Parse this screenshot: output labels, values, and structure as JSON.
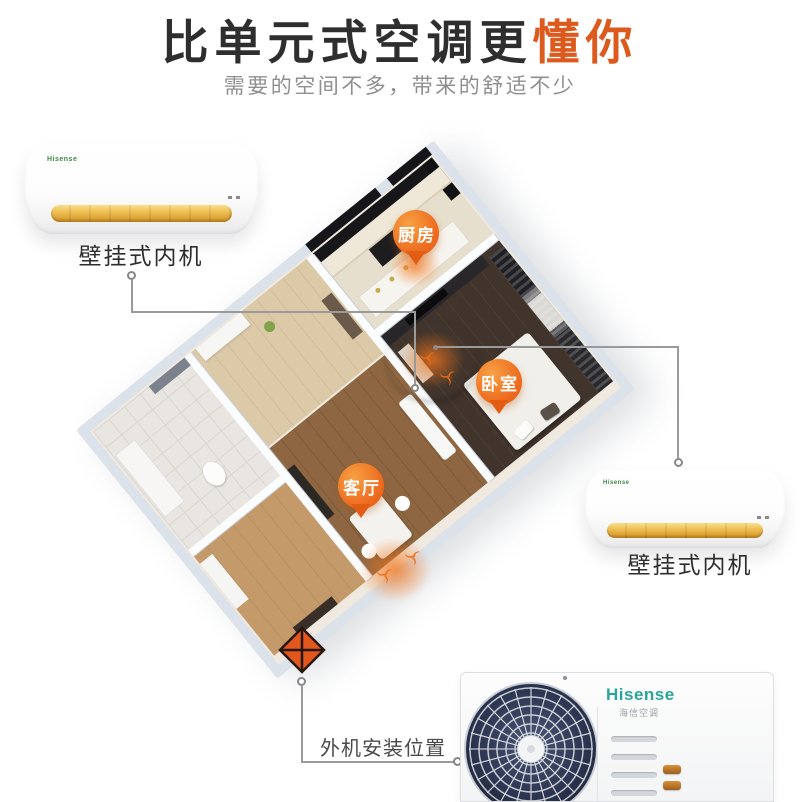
{
  "header": {
    "title_main": "比单元式空调更",
    "title_accent": "懂你",
    "subtitle": "需要的空间不多，带来的舒适不少"
  },
  "floorplan": {
    "rooms": [
      {
        "id": "kitchen",
        "label": "厨房"
      },
      {
        "id": "bedroom",
        "label": "卧室"
      },
      {
        "id": "living-room",
        "label": "客厅"
      }
    ]
  },
  "annotations": {
    "indoor_unit_left_label": "壁挂式内机",
    "indoor_unit_right_label": "壁挂式内机",
    "outdoor_unit_label": "外机安装位置"
  },
  "devices": {
    "indoor_logo": "Hisense",
    "outdoor": {
      "logo": "Hisense",
      "logo_sub": "海信空调"
    }
  },
  "icons": {
    "room_pin": "location-pin-icon",
    "airflow": "airflow-swirl-icon",
    "outdoor_marker": "diamond-cross-marker-icon"
  },
  "colors": {
    "accent_orange": "#DC5A1E",
    "pin_orange": "#EC661B",
    "gold_strip": "#EEBC4E",
    "hisense_teal": "#2BA59B",
    "wall_gray": "#DCE2EA"
  }
}
